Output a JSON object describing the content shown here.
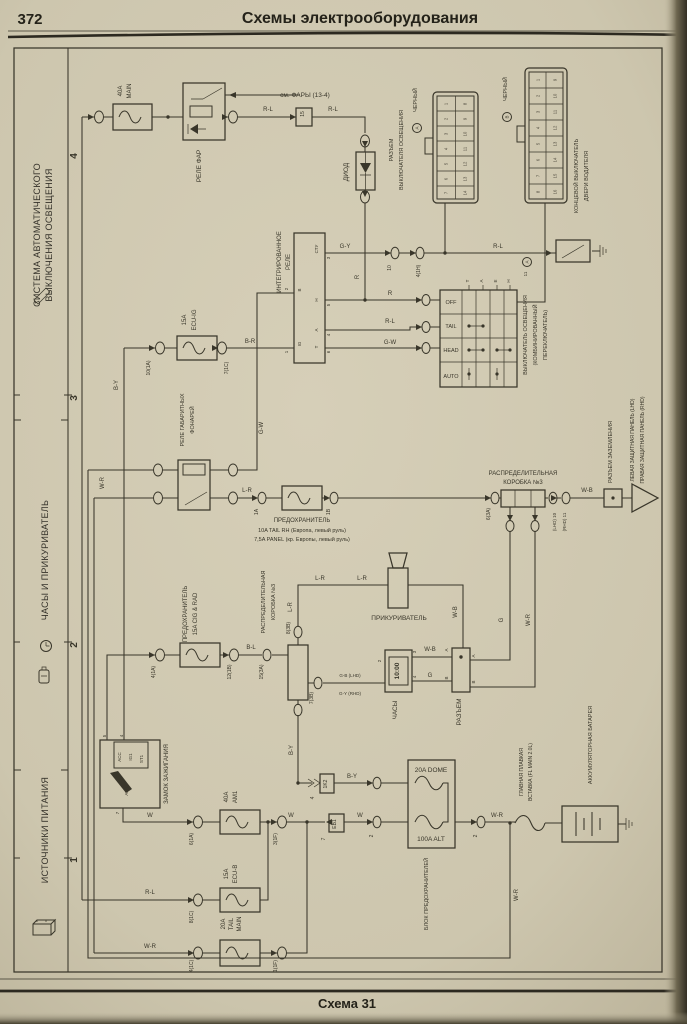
{
  "hdr": {
    "num": "372",
    "title": "Схемы электрооборудования"
  },
  "ftr": {
    "cap": "Схема 31"
  },
  "sb": {
    "s1a": "СИСТЕМА АВТОМАТИЧЕСКОГО",
    "s1b": "ВЫКЛЮЧЕНИЯ ОСВЕЩЕНИЯ",
    "s2": "ЧАСЫ И ПРИКУРИВАТЕЛЬ",
    "s3": "ИСТОЧНИКИ ПИТАНИЯ"
  },
  "marks": [
    "4",
    "3",
    "2",
    "1"
  ],
  "colors": {
    "paper": "#cdc6ae",
    "ink": "#39362a"
  },
  "c": {
    "f40a": "40A",
    "f40b": "MAIN",
    "rele_far": "РЕЛЕ ФАР",
    "see": "см. ФАРЫ (13-4)",
    "diod": "ДИОД",
    "rv1": "РАЗЪЕМ",
    "rv2": "ВЫКЛЮЧАТЕЛЯ ОСВЕЩЕНИЯ",
    "blk_a": "ЧЕРНЫЙ",
    "blk_b": "ЧЕРНЫЙ",
    "tag_a": "A",
    "tag_b": "B",
    "door1": "КОНЦЕВОЙ ВЫКЛЮЧАТЕЛЬ",
    "door2": "ДВЕРИ ВОДИТЕЛЯ",
    "ir1": "ИНТЕГРИРОВАННОЕ",
    "ir2": "РЕЛЕ",
    "ei1": "15A",
    "ei2": "ECU-IG",
    "rg1": "РЕЛЕ ГАБАРИТНЫХ",
    "rg2": "ФОНАРЕЙ",
    "ft1": "ПРЕДОХРАНИТЕЛЬ",
    "ft2": "10A TAIL RH (Европа, левый руль)",
    "ft3": "7,5A PANEL (кр. Европы, левый руль)",
    "ls1": "ВЫКЛЮЧАТЕЛЬ ОСВЕЩЕНИЯ",
    "ls2": "(КОМБИНИРОВАННЫЙ",
    "ls3": "ПЕРЕКЛЮЧАТЕЛЬ)",
    "ls_pin": "11",
    "ls_tag": "A",
    "d31": "РАСПРЕДЕЛИТЕЛЬНАЯ",
    "d32": "КОРОБКА №3",
    "gnd": "РАЗЪЕМ ЗАЗЕМЛЕНИЯ",
    "pnl1": "ЛЕВАЯ ЗАЩИТНАЯ ПАНЕЛЬ (LHD)",
    "pnl2": "ПРАВАЯ ЗАЩИТНАЯ ПАНЕЛЬ (RHD)",
    "fc1": "ПРЕДОХРАНИТЕЛЬ",
    "fc2": "15A CIG & RAD",
    "dm1": "РАСПРЕДЕЛИТЕЛЬНАЯ",
    "dm2": "КОРОБКА №3",
    "lighter": "ПРИКУРИВАТЕЛЬ",
    "clock": "ЧАСЫ",
    "time": "10:00",
    "razjem": "РАЗЪЕМ",
    "ign": "ЗАМОК ЗАЖИГАНИЯ",
    "fa1": "40A",
    "fa2": "AM1",
    "dome": "20A DOME",
    "alt": "100A ALT",
    "fblock": "БЛОК ПРЕДОХРАНИТЕЛЕЙ",
    "fl1": "ГЛАВНАЯ ПЛАВКАЯ",
    "fl2": "ВСТАВКА (FL MAIN 2.0L)",
    "bat": "АККУМУЛЯТОРНАЯ БАТАРЕЯ",
    "eb1": "15A",
    "eb2": "ECU-B",
    "tm1": "20A",
    "tm2": "TAIL",
    "tm3": "MAIN"
  },
  "pins": {
    "ir": [
      "СТУ",
      "H",
      "A",
      "T",
      "B",
      "IG",
      "3",
      "5",
      "4",
      "6",
      "2",
      "1"
    ],
    "ign": [
      "ACC",
      "IG1",
      "ST1",
      "AM1",
      "5",
      "4",
      "7"
    ],
    "clk": [
      "2",
      "3",
      "4"
    ],
    "rz": [
      "A",
      "A",
      "B",
      "B"
    ]
  },
  "table": {
    "modes": [
      "OFF",
      "TAIL",
      "HEAD",
      "AUTO"
    ],
    "terminals": [
      "T",
      "A",
      "E",
      "H"
    ]
  },
  "wires": [
    "R-L",
    "R-L",
    "G-Y",
    "R",
    "R",
    "R-L",
    "G-W",
    "R-L",
    "B-R",
    "B-Y",
    "G-W",
    "W-R",
    "L-R",
    "W-B",
    "B-L",
    "L-R",
    "L-R",
    "L-R",
    "W-B",
    "W-B",
    "G",
    "G",
    "W-R",
    "G-B (LHD)",
    "G-Y (RHD)",
    "W",
    "W",
    "W",
    "B-Y",
    "B-Y",
    "W-R",
    "R-L",
    "W-R",
    "W-R"
  ],
  "conns": [
    "10(1A)",
    "7(1C)",
    "4(1A)",
    "12(1B)",
    "15(3A)",
    "8(3B)",
    "7(3B)",
    "6(3A)",
    "(LHD) 10",
    "(RHD) 11",
    "6(1A)",
    "3(1F)",
    "2",
    "2",
    "8(1C)",
    "4(1C)",
    "1(1F)",
    "10",
    "4(1H)",
    "1K2",
    "4",
    "EB1",
    "7",
    "15",
    "11",
    "1A",
    "1B"
  ],
  "ga": [
    "1",
    "2",
    "3",
    "4",
    "5",
    "6",
    "7",
    "8",
    "9",
    "10",
    "11",
    "12",
    "13",
    "14"
  ],
  "gb": [
    "1",
    "2",
    "3",
    "4",
    "5",
    "6",
    "7",
    "8",
    "9",
    "10",
    "11",
    "12",
    "13",
    "14",
    "15",
    "16"
  ]
}
